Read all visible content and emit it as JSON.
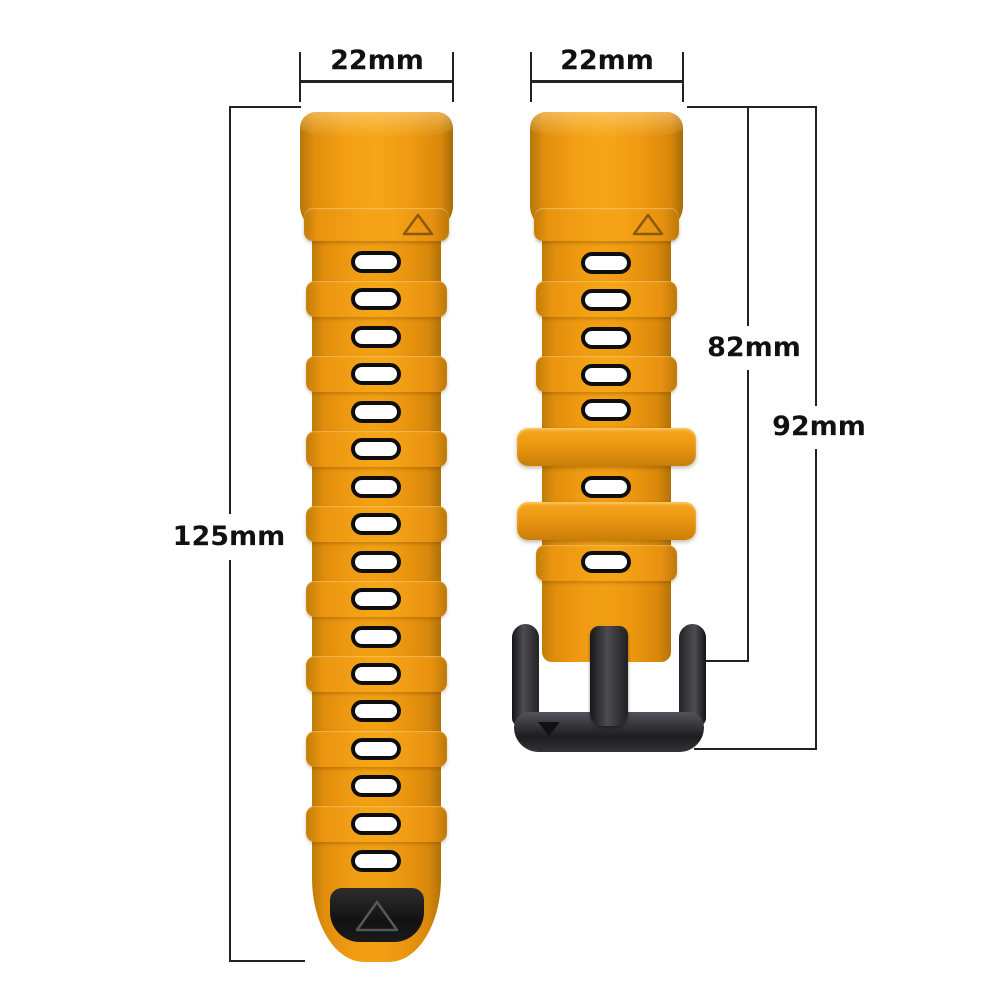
{
  "scene": {
    "description": "Dimension diagram of a two-piece orange silicone quick-release watch band with black buckle on white background",
    "background": "#FFFFFF"
  },
  "annotations": {
    "left_band_width": "22mm",
    "right_band_width": "22mm",
    "left_band_length": "125mm",
    "right_band_length": "82mm",
    "right_band_total_length": "92mm"
  },
  "parts": {
    "left_band": {
      "hole_count": 17
    },
    "right_band": {
      "hole_count": 7,
      "keeper_count": 2
    }
  },
  "colors": {
    "strap_orange": "#EC9510",
    "strap_orange_deep": "#C67C07",
    "strap_orange_light": "#F7A81E",
    "hole_fill": "#FFFFFF",
    "outline_black": "#0E0E0E",
    "buckle_gray": "#2B2B2F",
    "dim_line": "#222222",
    "label_text": "#111111",
    "background": "#FFFFFF"
  }
}
